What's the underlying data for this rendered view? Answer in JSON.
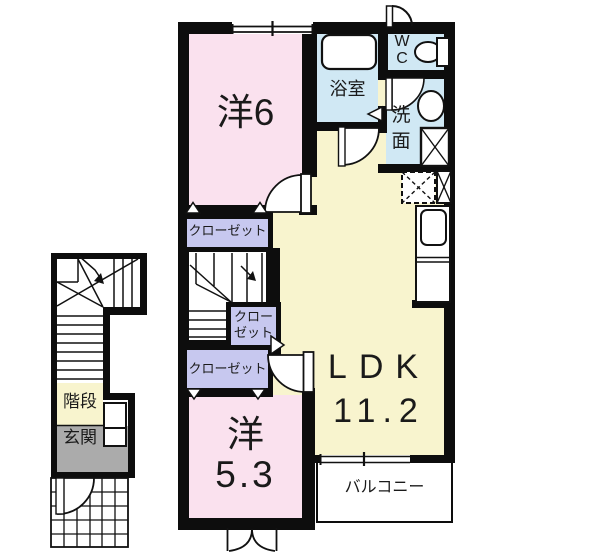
{
  "plan_type": "apartment-floor-plan",
  "rooms": {
    "bedroom_6": {
      "label": "洋6"
    },
    "bath": {
      "label": "浴室"
    },
    "wc": {
      "line1": "W",
      "line2": "C"
    },
    "washroom": {
      "line1": "洗",
      "line2": "面"
    },
    "ldk": {
      "label": "LDK",
      "area": "11.2"
    },
    "bedroom_5_3": {
      "label": "洋",
      "area": "5.3"
    },
    "balcony": {
      "label": "バルコニー"
    },
    "stairs": {
      "label": "階段"
    },
    "entrance": {
      "label": "玄関"
    },
    "closet_north": {
      "label": "クローゼット"
    },
    "closet_middle": {
      "line1": "クロー",
      "line2": "ゼット"
    },
    "closet_south": {
      "label": "クローゼット"
    }
  },
  "colors": {
    "room_pink": "#FAE1EE",
    "room_yellow": "#F8F4CE",
    "room_blue": "#D0E8F4",
    "closet_purple": "#C7C8EF",
    "entrance_gray": "#ABABAB",
    "wall_black": "#0D0D0D"
  }
}
